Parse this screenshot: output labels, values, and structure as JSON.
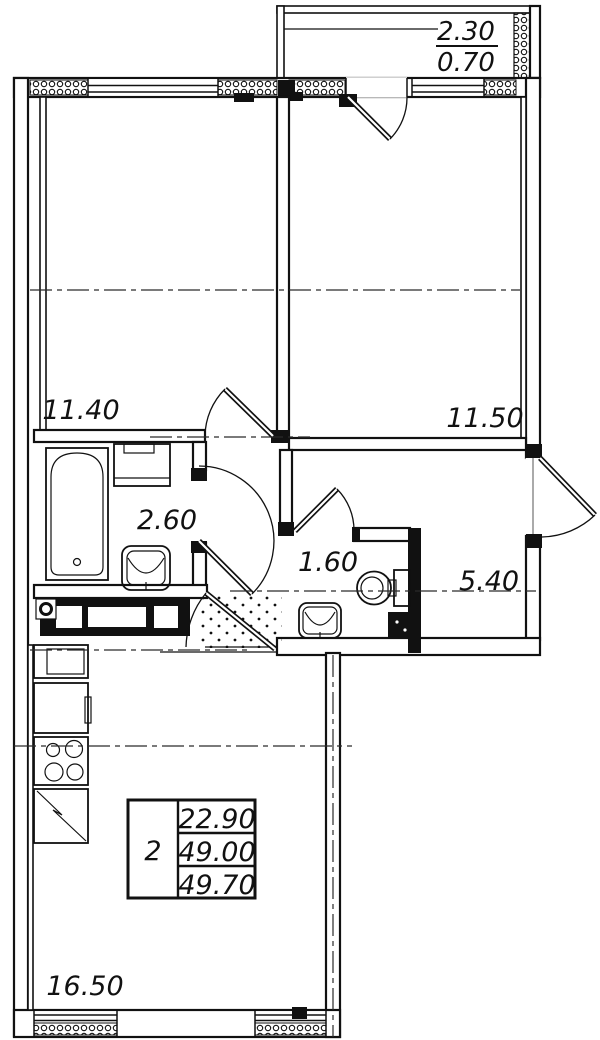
{
  "plan": {
    "balcony": {
      "dim_top": "2.30",
      "dim_bottom": "0.70"
    },
    "rooms": {
      "bedroom1": "11.40",
      "bedroom2": "11.50",
      "bathroom": "2.60",
      "wc": "1.60",
      "hall": "5.40",
      "kitchen_living": "16.50"
    },
    "summary": {
      "rooms_count": "2",
      "living_area": "22.90",
      "apartment_area": "49.00",
      "total_area": "49.70"
    },
    "colors": {
      "line": "#111111",
      "background": "#ffffff"
    }
  }
}
